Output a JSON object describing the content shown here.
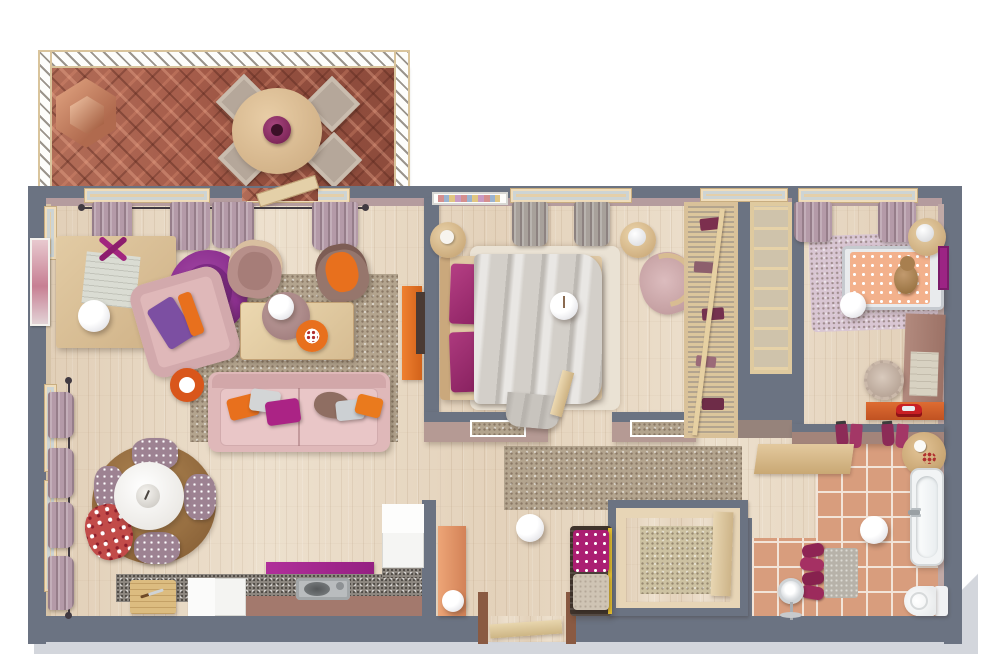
{
  "meta": {
    "type": "3d-floor-plan-render",
    "view": "top-down"
  },
  "palette": {
    "background": "#ffffff",
    "wall": "#6b7382",
    "wall_face_mauve": "#b59c9e",
    "wall_face_brown": "#a3847a",
    "foundation": "#d3d6dc",
    "wood": "#e8d9c4",
    "wood_frame": "#e0c9a2",
    "brick": "#a55c4a",
    "tile": "#d89d7d",
    "grout": "#f2e4d8",
    "rug_speckle": "#b3a48e",
    "rug_round": "#9b7244",
    "rug_bed": "#eae2d4",
    "rug_kids": "#d9c6d3",
    "rug_storage": "#cdc2a2",
    "sofa_pink": "#dfb8b9",
    "sofa_pink_light": "#e9c6c7",
    "magenta": "#ab2385",
    "purple": "#7c4fa2",
    "orange": "#e8701d",
    "copper": "#cf8f6e",
    "duvet": "#d3cfc9",
    "granite": "#8d8780",
    "cabinet": "#a3796d",
    "console_salmon": "#e09167",
    "chrome": "#cfd3d6",
    "wicker": "#3f332b",
    "toy_red": "#c91f24",
    "curtain": "#b49aa8",
    "mattress_kids": "#f3b18c"
  },
  "rooms": {
    "balcony": {
      "label": "balcony",
      "items": [
        "railing",
        "herringbone-brick-floor",
        "hex-planter",
        "round-dining-table",
        "vase",
        "outdoor-chairs"
      ]
    },
    "living_room": {
      "label": "living-room",
      "items": [
        "desk",
        "desk-chair",
        "desk-lamp",
        "wall-art",
        "armchair",
        "accent-chair",
        "accent-chair-orange",
        "coffee-table",
        "ottoman",
        "ceiling-lamp",
        "serving-tray",
        "sofa",
        "throw-pillows",
        "orange-side-table",
        "area-rug",
        "tv-sideboard",
        "windows",
        "curtains"
      ]
    },
    "dining_nook": {
      "label": "dining-nook",
      "items": [
        "round-rug",
        "round-table",
        "vase",
        "dotted-chairs",
        "floral-chair"
      ]
    },
    "kitchen": {
      "label": "kitchen",
      "items": [
        "granite-counter",
        "sink",
        "appliance",
        "fridge",
        "cutting-board",
        "magenta-backsplash",
        "cabinets"
      ]
    },
    "entry": {
      "label": "entry",
      "items": [
        "console-table",
        "sphere-lamp",
        "entry-door"
      ]
    },
    "hallway": {
      "label": "hallway",
      "items": [
        "runner-rug",
        "ceiling-lamp",
        "daybed-bench",
        "dotted-pillow",
        "beige-pillow"
      ]
    },
    "master_bedroom": {
      "label": "master-bedroom",
      "items": [
        "double-bed",
        "magenta-pillows",
        "duvet",
        "bed-rug",
        "nightstand",
        "ceiling-lamp",
        "accent-chair",
        "side-table",
        "window",
        "curtains",
        "wall-art",
        "door",
        "radiator-vents"
      ]
    },
    "walk_in_closet": {
      "label": "walk-in-closet",
      "items": [
        "wardrobe-with-clothes",
        "ladder-shelves"
      ]
    },
    "kids_room": {
      "label": "kids-room",
      "items": [
        "single-bed",
        "teddy-bear",
        "lavender-rug",
        "ceiling-lamp",
        "side-table",
        "desk",
        "desk-pad",
        "fluffy-stool",
        "toy-table",
        "toy-car",
        "window",
        "curtains",
        "wall-art"
      ]
    },
    "storage_room": {
      "label": "storage-room",
      "items": [
        "beige-rug",
        "wood-partition"
      ]
    },
    "bathroom": {
      "label": "bathroom",
      "items": [
        "bathtub",
        "toilet",
        "towel-hooks",
        "towel-rack",
        "bath-mat",
        "vanity-shelf",
        "side-table",
        "standing-fan",
        "ceiling-lamp",
        "tile-floor"
      ]
    }
  }
}
